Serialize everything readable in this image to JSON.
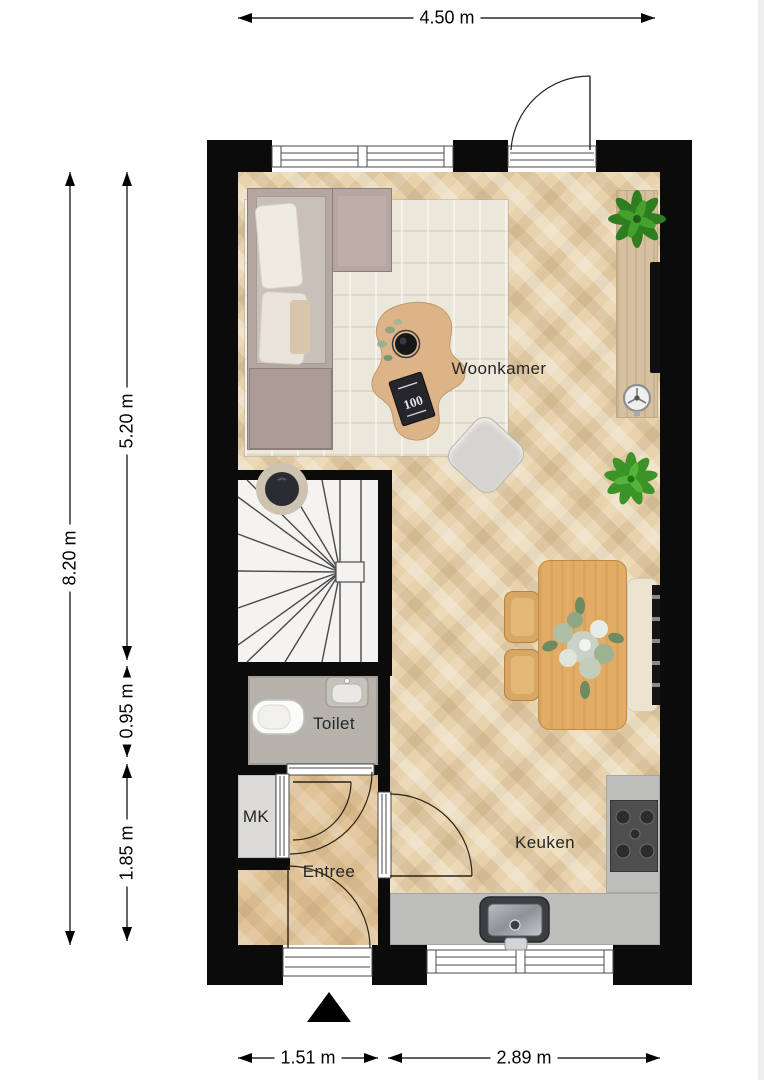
{
  "plan_title": "floor-plan",
  "rooms": {
    "woonkamer": {
      "label": "Woonkamer"
    },
    "toilet": {
      "label": "Toilet"
    },
    "mk": {
      "label": "MK"
    },
    "entree": {
      "label": "Entree"
    },
    "keuken": {
      "label": "Keuken"
    }
  },
  "dimensions": {
    "width_total": "4.50 m",
    "height_total": "8.20 m",
    "height_living": "5.20 m",
    "height_toilet": "0.95 m",
    "height_entree": "1.85 m",
    "width_entree": "1.51 m",
    "width_kitchen": "2.89 m"
  },
  "decor": {
    "book_label": "100"
  },
  "colors": {
    "wall": "#0b0b0b",
    "wood_floor": "#e7d2ac",
    "rug": "#ece7db",
    "counter_gray": "#bdbdbb",
    "plant_green": "#3f9a2d",
    "sofa_taupe": "#b4a7a2"
  }
}
